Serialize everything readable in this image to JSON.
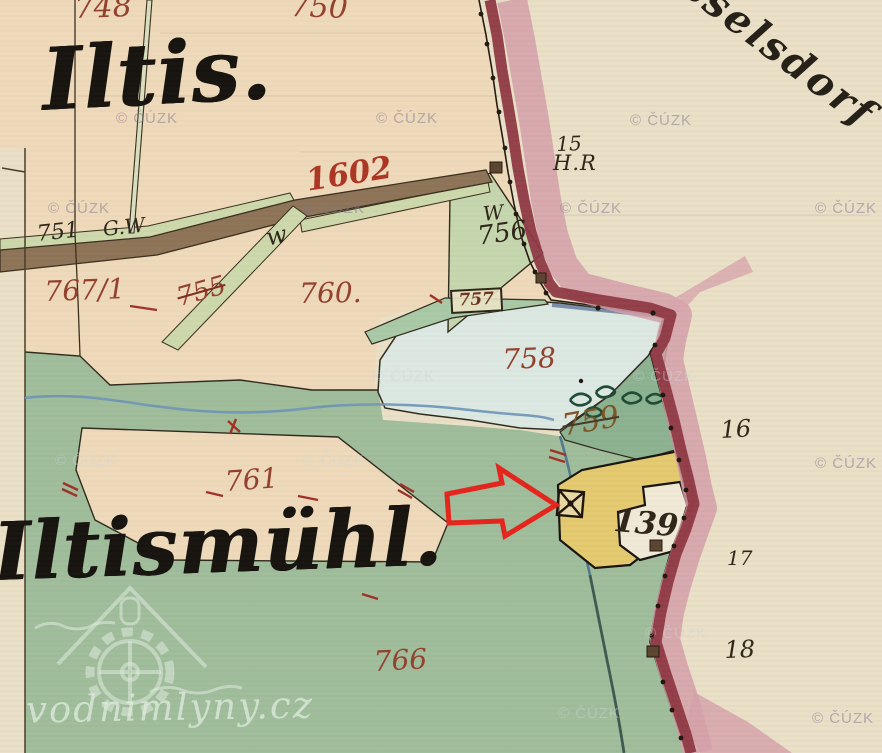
{
  "map": {
    "place_names": {
      "iltis": "Iltis.",
      "iltismuhl": "Iltismühl.",
      "neighbor_fragment": "sselsdorf"
    },
    "parcel_labels": [
      {
        "text": "748"
      },
      {
        "text": "750"
      },
      {
        "text": "1602"
      },
      {
        "text": "751"
      },
      {
        "text": "G.W"
      },
      {
        "text": "w"
      },
      {
        "text": "W"
      },
      {
        "text": "756"
      },
      {
        "text": "767/1"
      },
      {
        "text": "755"
      },
      {
        "text": "760."
      },
      {
        "text": "757"
      },
      {
        "text": "758"
      },
      {
        "text": "759"
      },
      {
        "text": "761"
      },
      {
        "text": "766"
      },
      {
        "text": "139"
      },
      {
        "text": "15"
      },
      {
        "text": "H.R"
      },
      {
        "text": "16"
      },
      {
        "text": "17"
      },
      {
        "text": "18"
      }
    ],
    "watermark": {
      "label": "© ČÚZK"
    },
    "credit": {
      "label": "vodnimlyny.cz"
    },
    "colors": {
      "paper": "#e9dfc6",
      "field": "#eed9ba",
      "meadow": "#9fbc9a",
      "pond": "#dce8e2",
      "road": "#8d7457",
      "border_line": "#8e3843",
      "border_band": "#d4a0a9",
      "building": "#e4c96f",
      "building_annex": "#f0e9d6",
      "stream": "#6b93b8",
      "number_ink": "#93402e",
      "text_ink": "#2e2618",
      "arrow": "#e6241c"
    }
  }
}
